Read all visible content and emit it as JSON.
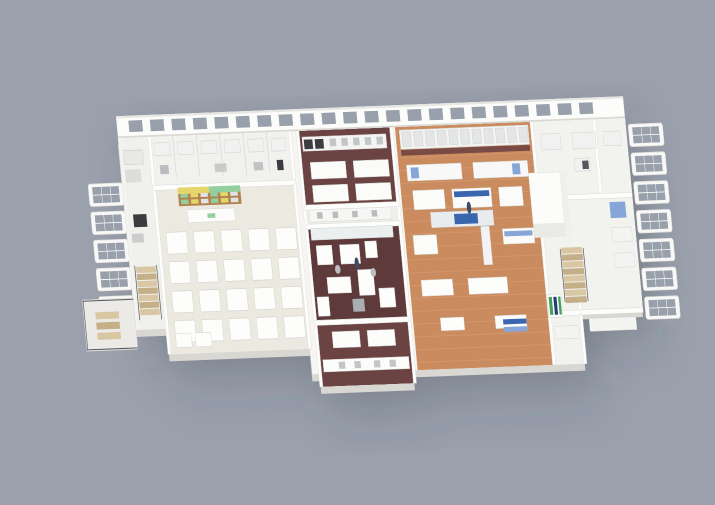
{
  "scene": {
    "description": "3D isometric cutaway rendering of a laboratory and food-production facility floor plan on a gray background",
    "background": "#9aa0ac",
    "palette": {
      "shadow": "rgba(52,57,68,0.35)",
      "slab": "#f6f5f2",
      "slab_side": "#d8d7d2",
      "wall": "#fcfcfa",
      "wall_edge": "#d9d9d4",
      "window_pane": "#98a0ab",
      "glass": "#c6cdd4",
      "floor_white": "#f1f1ed",
      "floor_cafeteria": "#ebe9e0",
      "floor_maroon": "#6b4343",
      "floor_maroon_dark": "#5e3a3a",
      "floor_orange": "#ca8b5e",
      "tile_line": "#dda37a",
      "equipment_white": "#fdfdfc",
      "equipment_edge": "#d2d2cc",
      "equipment_gray": "#c2c6c6",
      "steel": "#a8aeb1",
      "dark_appliance": "#3c3c40",
      "blue_accent": "#3a66b0",
      "blue_light": "#85a6d6",
      "navy": "#1f3f7a",
      "green_accent": "#45a05a",
      "kiosk_yellow": "#e5d66a",
      "kiosk_green": "#93cf9f",
      "kiosk_wood": "#b2834e",
      "stair_wood_light": "#d9c7a4",
      "stair_wood_dark": "#c4af89",
      "railing": "#565a60",
      "person": "#3e4a5f"
    },
    "zones": [
      {
        "id": "left-wing",
        "label": "Left service wing with staircase and balcony",
        "floor": "#f0f0ec"
      },
      {
        "id": "cafeteria",
        "label": "Cafeteria seating area with shop kiosk",
        "floor": "#ebe9e0"
      },
      {
        "id": "back-lab-left",
        "label": "Back laboratory row behind cafeteria",
        "floor": "#f1f1ed"
      },
      {
        "id": "lab-maroon",
        "label": "Laboratory with white island benches on maroon floor",
        "floor": "#6b4343"
      },
      {
        "id": "kitchen",
        "label": "Central training kitchen on dark maroon floor",
        "floor": "#5e3a3a"
      },
      {
        "id": "production",
        "label": "Food production hall on terracotta tile floor with blue-accent machine lines",
        "floor": "#ca8b5e"
      },
      {
        "id": "clean-room",
        "label": "White clean-room enclosure",
        "floor": "#fcfcfa"
      },
      {
        "id": "right-wing",
        "label": "Right laboratory wing with staircase and window wall",
        "floor": "#f2f2ef"
      }
    ],
    "counts": {
      "cafeteria_table_rows": 4,
      "cafeteria_table_cols": 5,
      "back_wall_windows": 22,
      "right_window_modules": 7,
      "left_window_modules": 6,
      "right_stair_steps": 8,
      "left_stair_steps": 7,
      "kiosk_shelf_items": 12,
      "production_tile_rows": 19,
      "back_machine_units": 11,
      "people": 2
    }
  }
}
